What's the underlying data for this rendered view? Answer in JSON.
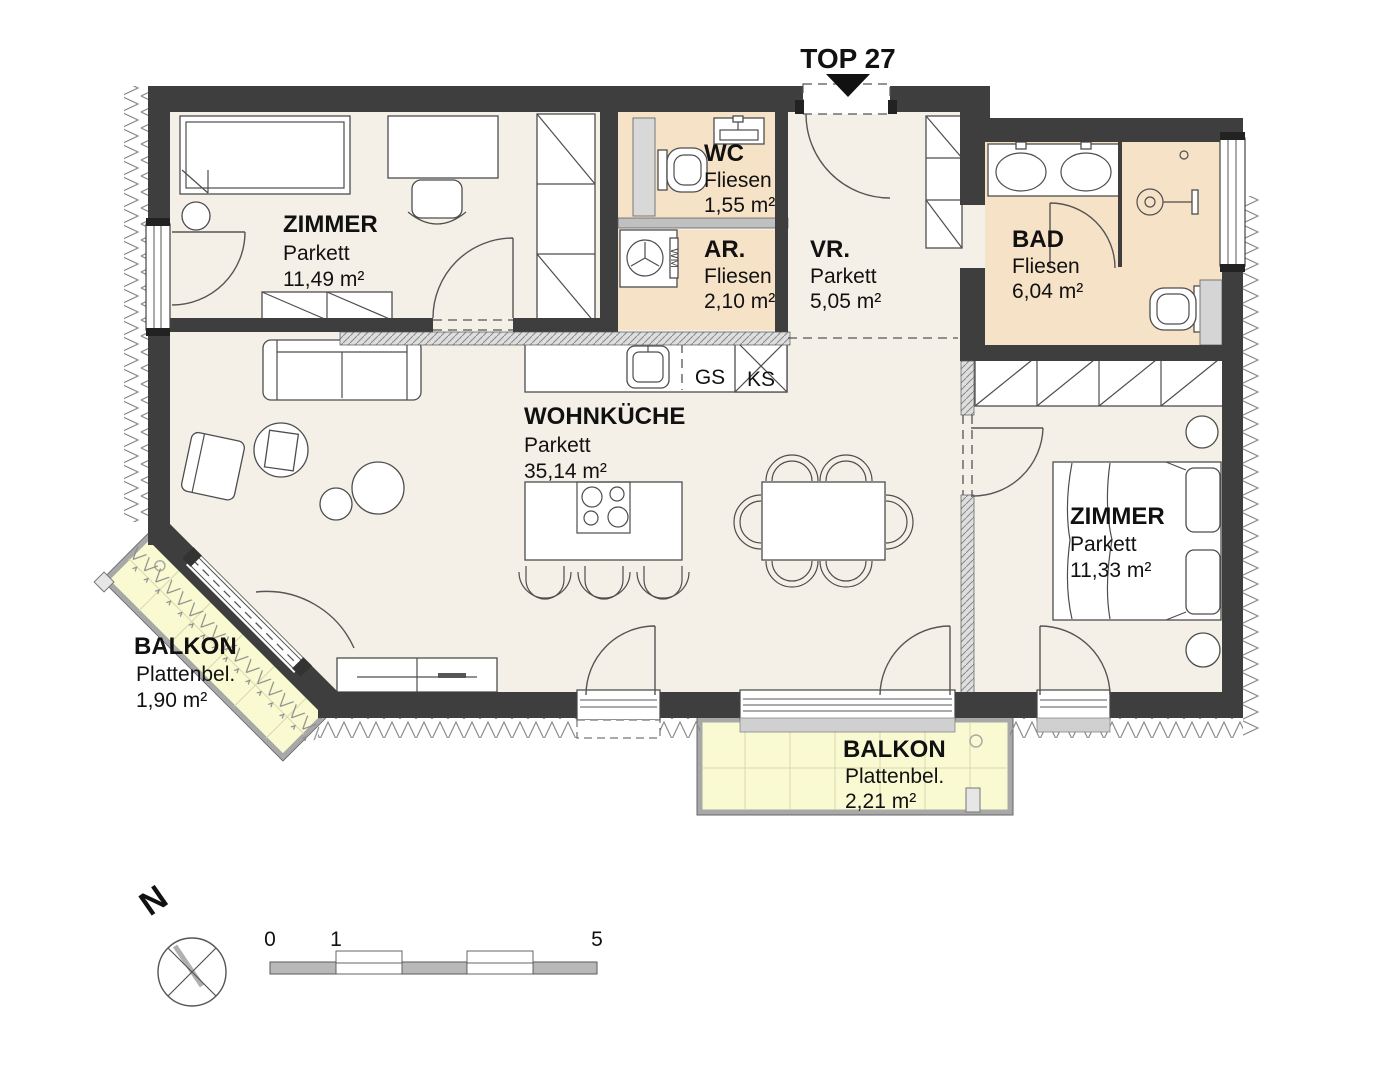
{
  "title": "TOP 27",
  "rooms": {
    "zimmer1": {
      "name": "ZIMMER",
      "floor": "Parkett",
      "area": "11,49 m²"
    },
    "wc": {
      "name": "WC",
      "floor": "Fliesen",
      "area": "1,55 m²"
    },
    "ar": {
      "name": "AR.",
      "floor": "Fliesen",
      "area": "2,10 m²"
    },
    "vr": {
      "name": "VR.",
      "floor": "Parkett",
      "area": "5,05 m²"
    },
    "bad": {
      "name": "BAD",
      "floor": "Fliesen",
      "area": "6,04 m²"
    },
    "wohnkueche": {
      "name": "WOHNKÜCHE",
      "floor": "Parkett",
      "area": "35,14 m²"
    },
    "zimmer2": {
      "name": "ZIMMER",
      "floor": "Parkett",
      "area": "11,33 m²"
    },
    "balkon1": {
      "name": "BALKON",
      "floor": "Plattenbel.",
      "area": "1,90 m²"
    },
    "balkon2": {
      "name": "BALKON",
      "floor": "Plattenbel.",
      "area": "2,21 m²"
    }
  },
  "appliances": {
    "dishwasher": "GS",
    "fridge": "KS",
    "washer": "WM"
  },
  "compass": {
    "north": "N"
  },
  "scale_bar": {
    "ticks": [
      "0",
      "1",
      "5"
    ]
  },
  "colors": {
    "wall": "#3e3e3e",
    "parkett": "#f5f0e7",
    "fliesen": "#f6e2c6",
    "balkon": "#fafad2"
  }
}
